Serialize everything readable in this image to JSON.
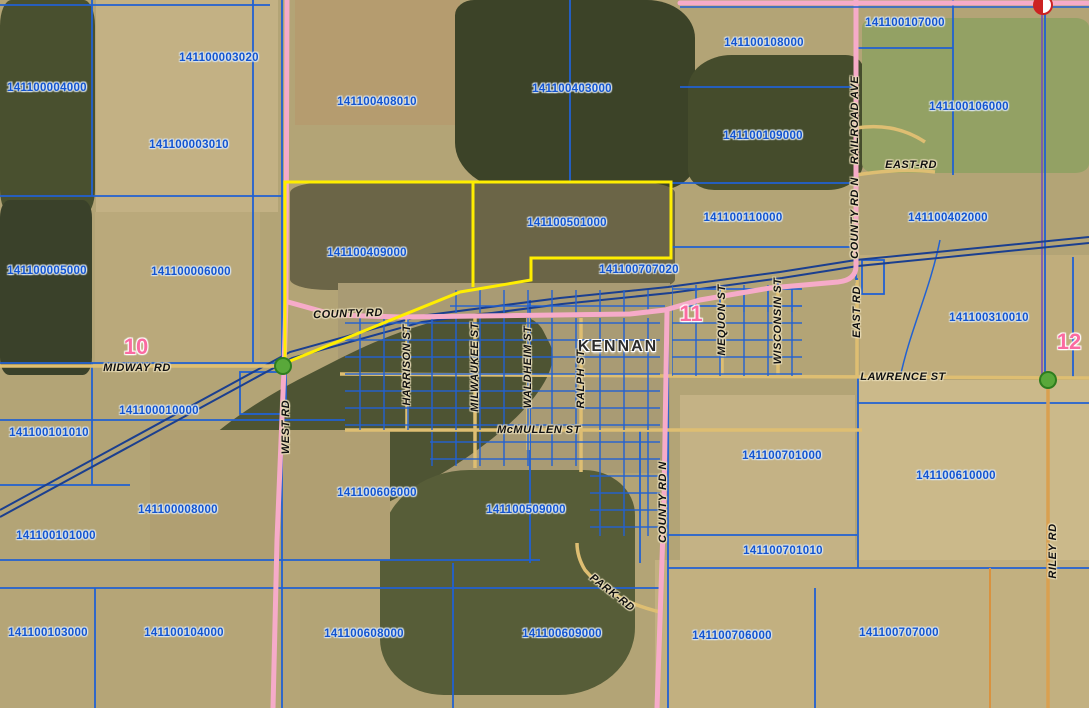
{
  "town": {
    "name": "KENNAN"
  },
  "sections": [
    {
      "number": "10"
    },
    {
      "number": "11"
    },
    {
      "number": "12"
    }
  ],
  "parcels": [
    {
      "id": "141100004000"
    },
    {
      "id": "141100003020"
    },
    {
      "id": "141100003010"
    },
    {
      "id": "141100408010"
    },
    {
      "id": "141100403000"
    },
    {
      "id": "141100108000"
    },
    {
      "id": "141100107000"
    },
    {
      "id": "141100106000"
    },
    {
      "id": "141100109000"
    },
    {
      "id": "141100402000"
    },
    {
      "id": "141100110000"
    },
    {
      "id": "141100501000"
    },
    {
      "id": "141100409000"
    },
    {
      "id": "141100707020"
    },
    {
      "id": "141100005000"
    },
    {
      "id": "141100006000"
    },
    {
      "id": "141100310010"
    },
    {
      "id": "141100010000"
    },
    {
      "id": "141100101010"
    },
    {
      "id": "141100008000"
    },
    {
      "id": "141100101000"
    },
    {
      "id": "141100606000"
    },
    {
      "id": "141100509000"
    },
    {
      "id": "141100701000"
    },
    {
      "id": "141100610000"
    },
    {
      "id": "141100701010"
    },
    {
      "id": "141100103000"
    },
    {
      "id": "141100104000"
    },
    {
      "id": "141100608000"
    },
    {
      "id": "141100609000"
    },
    {
      "id": "141100706000"
    },
    {
      "id": "141100707000"
    }
  ],
  "roads": {
    "county_rd": "COUNTY RD",
    "midway_rd": "MIDWAY RD",
    "mcmullen_st": "McMULLEN ST",
    "lawrence_st": "LAWRENCE ST",
    "east_rd_h": "EAST-RD",
    "park_rd": "PARK-RD",
    "west_rd": "WEST RD",
    "harrison_st": "HARRISON ST",
    "milwaukee_st": "MILWAUKEE ST",
    "waldheim_st": "WALDHEIM ST",
    "ralph_st": "RALPH ST",
    "mequon_st": "MEQUON ST",
    "wisconsin_st": "WISCONSIN ST",
    "east_rd_v": "EAST RD",
    "county_rd_n_top": "COUNTY RD N",
    "railroad_ave": "RAILROAD AVE",
    "county_rd_n_south": "COUNTY RD N",
    "riley_rd": "RILEY RD"
  },
  "colors": {
    "parcel_line": "#1e5ed0",
    "parcel_label": "#1254d0",
    "selected_highlight": "#ffee00",
    "road_pink": "#f6abc9",
    "road_tan": "#debe72",
    "railroad": "#1b3f8f",
    "section_label": "#fb6ba1",
    "marker_green": "#59a83a",
    "marker_red": "#cc2222",
    "riley_orange": "#d9a050"
  }
}
